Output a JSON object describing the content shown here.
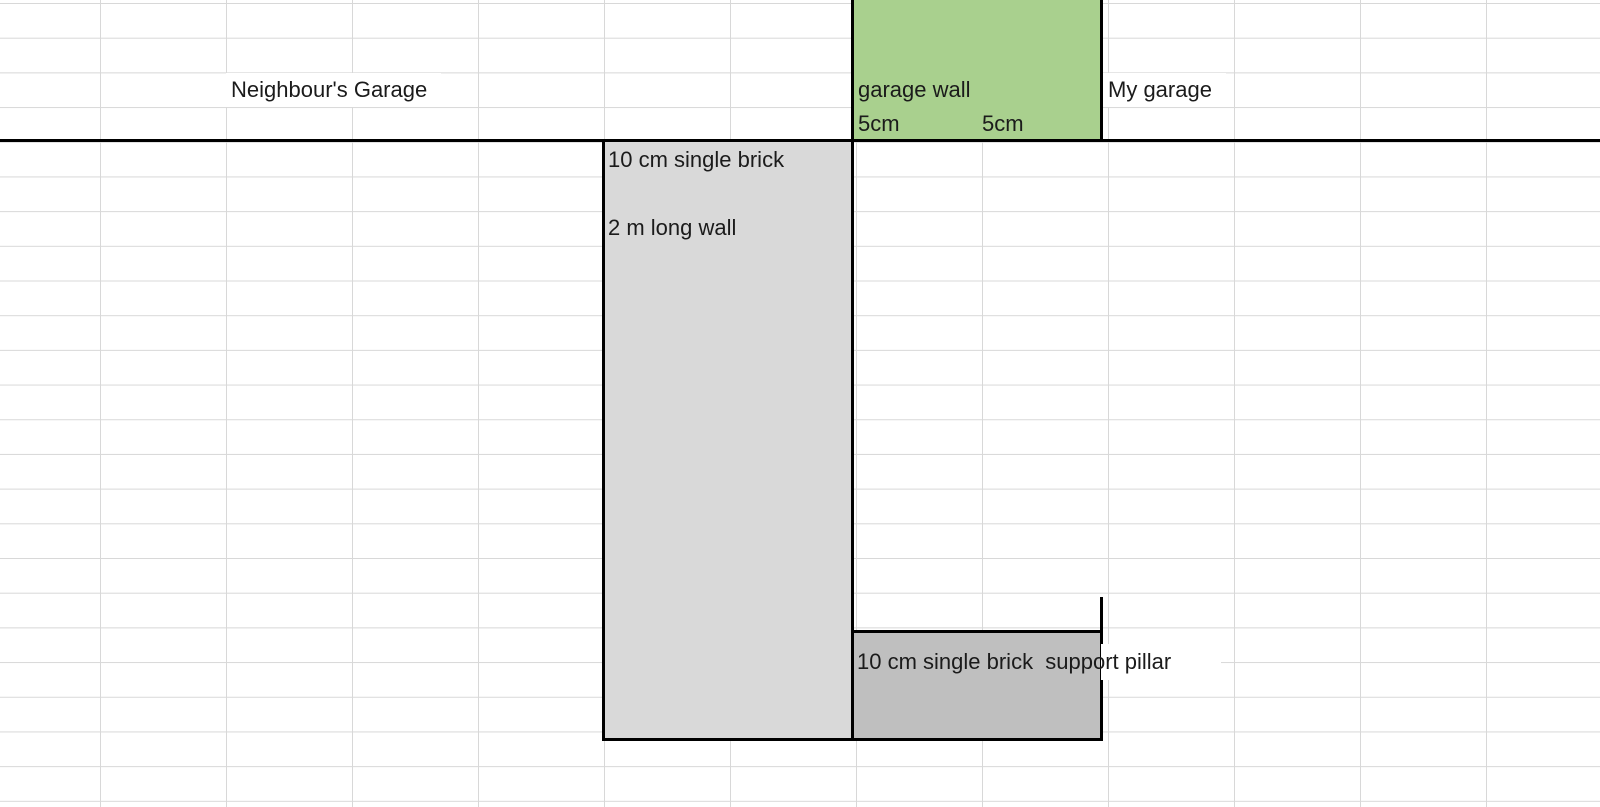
{
  "sheet": {
    "gridline_color": "#d8d8d8",
    "line_color": "#000000",
    "labels": {
      "neighbours_garage": "Neighbour's Garage",
      "my_garage": "My garage"
    }
  },
  "shapes": {
    "garage_wall": {
      "label": "garage wall",
      "dim_left": "5cm",
      "dim_right": "5cm",
      "fill": "#a9d08e"
    },
    "long_wall": {
      "line1": "10 cm single brick",
      "line2": "2 m long wall",
      "fill": "#d9d9d9"
    },
    "support_pillar": {
      "label": "10 cm single brick  support pillar",
      "fill": "#bfbfbf"
    }
  }
}
